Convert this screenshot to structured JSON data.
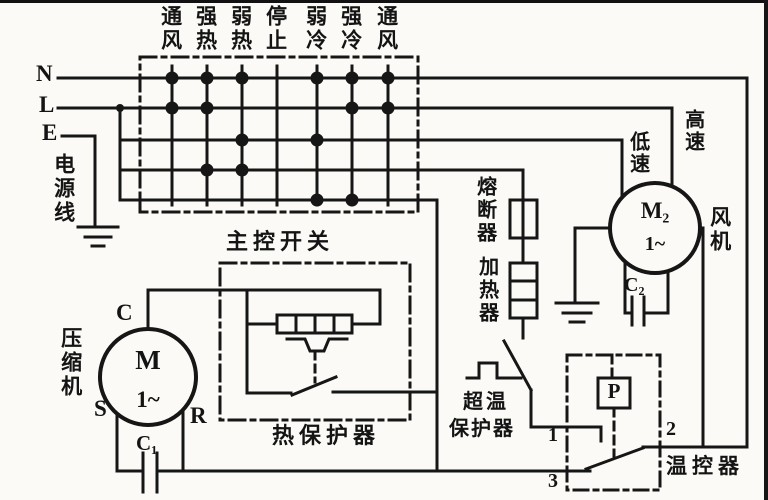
{
  "diagram": {
    "kind": "air-conditioner electrical wiring schematic (scanned, Chinese)",
    "power": {
      "n_label": "N",
      "l_label": "L",
      "e_label": "E",
      "source_label": "电源线"
    },
    "main_switch": {
      "label": "主控开关",
      "modes": [
        "通风",
        "强热",
        "弱热",
        "停止",
        "弱冷",
        "强冷",
        "通风"
      ],
      "contact_rows": [
        {
          "row": "N-line",
          "closed_in_columns": [
            1,
            2,
            3,
            5,
            6,
            7
          ]
        },
        {
          "row": "fan-high",
          "closed_in_columns": [
            1,
            2,
            6,
            7
          ]
        },
        {
          "row": "fan-low",
          "closed_in_columns": [
            3,
            5
          ]
        },
        {
          "row": "heater",
          "closed_in_columns": [
            2,
            3
          ]
        },
        {
          "row": "compressor",
          "closed_in_columns": [
            5,
            6
          ]
        }
      ]
    },
    "compressor": {
      "label": "压缩机",
      "motor": "M",
      "phase": "1~",
      "terminal_c": "C",
      "terminal_s": "S",
      "terminal_r": "R",
      "capacitor": "C₁"
    },
    "thermal_protector": {
      "label": "热保护器"
    },
    "fuse": {
      "label": "熔断器"
    },
    "heater": {
      "label": "加热器"
    },
    "overtemp_protector": {
      "label_line1": "超温",
      "label_line2": "保护器"
    },
    "fan": {
      "label": "风机",
      "motor": "M₂",
      "phase": "1~",
      "capacitor": "C₂",
      "low_speed": "低速",
      "high_speed": "高速"
    },
    "thermostat": {
      "label": "温控器",
      "sensor": "P",
      "terminal_1": "1",
      "terminal_2": "2",
      "terminal_3": "3"
    },
    "colors": {
      "ink": "#161616",
      "paper": "#fbfaf6"
    }
  },
  "layout_hints": {
    "matrix_col_x": [
      172,
      207,
      242,
      277,
      317,
      352,
      388
    ],
    "matrix_row_y": [
      78,
      108,
      140,
      170,
      200
    ]
  }
}
